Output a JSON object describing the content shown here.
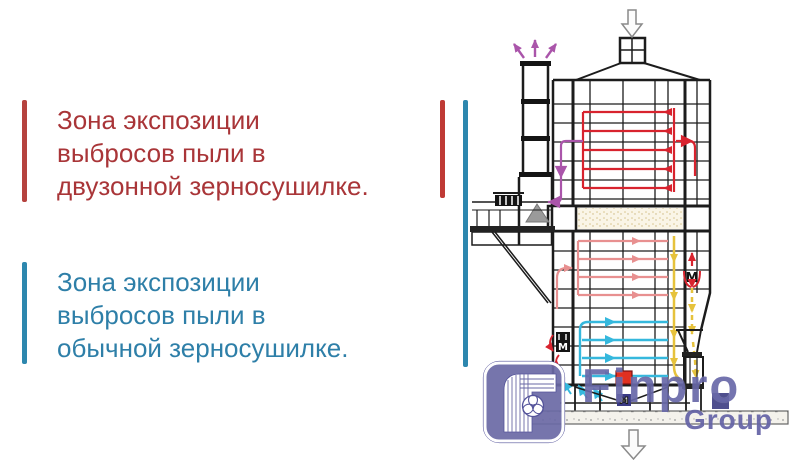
{
  "slide": {
    "background": "#ffffff"
  },
  "notes": {
    "dual_zone": {
      "line1": "Зона экспозиции",
      "line2": "выбросов пыли в",
      "line3": "двузонной зерносушилке.",
      "text_color": "#a93538",
      "bar_color": "#b5423e"
    },
    "regular": {
      "line1": "Зона экспозиции",
      "line2": "выбросов пыли в",
      "line3": "обычной зерносушилке.",
      "text_color": "#2e7fa8",
      "bar_color": "#2d87ae"
    }
  },
  "zone_markers": {
    "dual_zone_bar_color": "#bf3a35",
    "regular_bar_color": "#2d87ae"
  },
  "diagram": {
    "subject": "grain-dryer-airflow-schematic",
    "fan_label": "M",
    "flow_colors": {
      "hot_air": "#d8232e",
      "warm_air": "#e89090",
      "cool_air": "#35b8dd",
      "exhaust": "#aa55aa",
      "grain": "#e6c23c"
    }
  },
  "logo": {
    "name": "Finpro",
    "subtitle": "Group",
    "color": "#56559e"
  }
}
